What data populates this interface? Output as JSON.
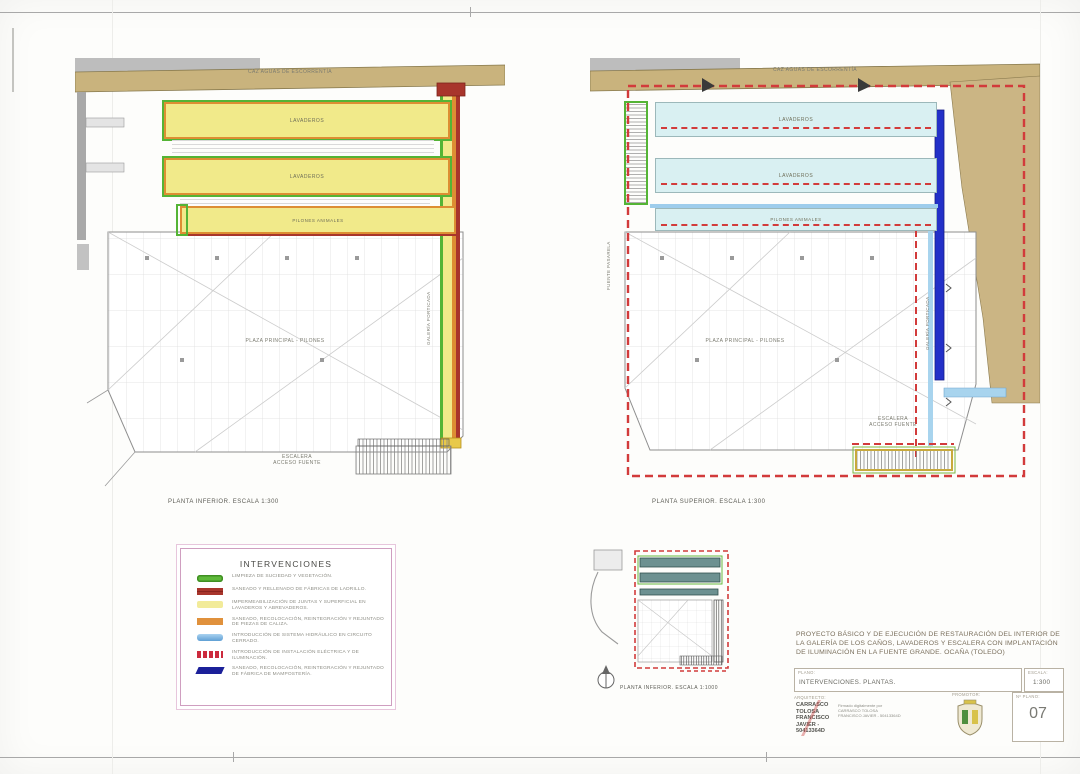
{
  "plans": {
    "lower": {
      "caption": "PLANTA INFERIOR. ESCALA 1:300",
      "caz_label": "CAZ AGUAS DE ESCORRENTÍA",
      "lavadero1_label": "LAVADEROS",
      "lavadero2_label": "LAVADEROS",
      "pilones_label": "PILONES ANIMALES",
      "plaza_label": "PLAZA PRINCIPAL - PILONES",
      "stairs_label": "ESCALERA\nACCESO FUENTE",
      "gallery_label": "GALERÍA PORTICADA"
    },
    "upper": {
      "caption": "PLANTA SUPERIOR. ESCALA 1:300",
      "caz_label": "CAZ AGUAS DE ESCORRENTÍA",
      "lavadero1_label": "LAVADEROS",
      "lavadero2_label": "LAVADEROS",
      "pilones_label": "PILONES ANIMALES",
      "plaza_label": "PLAZA PRINCIPAL - PILONES",
      "stairs_label": "ESCALERA\nACCESO FUENTE",
      "gallery_label": "GALERÍA PORTICADA",
      "pasarela_label": "FUENTE PASARELA"
    },
    "key": {
      "caption": "PLANTA INFERIOR. ESCALA 1:1000"
    }
  },
  "legend": {
    "title": "INTERVENCIONES",
    "items": [
      {
        "label": "LIMPIEZA DE SUCIEDAD Y VEGETACIÓN.",
        "color": "#5eb93a",
        "swatch_css": "background:#5eb93a;box-shadow:inset 0 0 0 1.5px #3f8f22;border-radius:3px"
      },
      {
        "label": "SANEADO Y RELLENADO DE FÁBRICAS DE LADRILLO.",
        "color": "#a8352c",
        "swatch_css": "background:repeating-linear-gradient(0deg,#a8352c 0 3px,#8a241e 3px 4px)"
      },
      {
        "label": "IMPERMEABILIZACIÓN DE JUNTAS Y SUPERFICIAL EN LAVADEROS Y ABREVADEROS.",
        "color": "#f2eb9a",
        "swatch_css": "background:#f2eb9a;border-radius:2px"
      },
      {
        "label": "SANEADO, RECOLOCACIÓN, REINTEGRACIÓN Y REJUNTADO DE PIEZAS DE CALIZA.",
        "color": "#e0913c",
        "swatch_css": "background:#e0913c"
      },
      {
        "label": "INTRODUCCIÓN DE SISTEMA HIDRÁULICO EN CIRCUITO CERRADO.",
        "color": "#7fb9e4",
        "swatch_css": "background:linear-gradient(#a9d2f0,#5f9fd4);border-radius:3px"
      },
      {
        "label": "INTRODUCCIÓN DE INSTALACIÓN ELÉCTRICA Y DE ILUMINACIÓN.",
        "color": "#cc2a3d",
        "swatch_css": "background:repeating-linear-gradient(90deg,#cc2a3d 0 4px,#ffffff 4px 6px)"
      },
      {
        "label": "SANEADO, RECOLOCACIÓN, REINTEGRACIÓN Y REJUNTADO DE FÁBRICA DE MAMPOSTERÍA.",
        "color": "#1b2099",
        "swatch_css": "background:#1b2099;transform:skewX(-25deg)"
      }
    ]
  },
  "titleblock": {
    "project_title": "PROYECTO BÁSICO Y DE EJECUCIÓN DE RESTAURACIÓN DEL INTERIOR DE LA GALERÍA DE LOS CAÑOS, LAVADEROS Y ESCALERA CON IMPLANTACIÓN DE ILUMINACIÓN EN LA FUENTE GRANDE. OCAÑA (TOLEDO)",
    "plano_label": "PLANO:",
    "plano_value": "INTERVENCIONES. PLANTAS.",
    "escala_label": "ESCALA:",
    "escala_value": "1:300",
    "arquitecto_label": "ARQUITECTO:",
    "arquitecto_name": "CARRASCO\nTOLOSA\nFRANCISCO\nJAVIER -\n50413364D",
    "signature_text": "Firmado digitalmente por CARRASCO TOLOSA FRANCISCO JAVIER - 50413364D",
    "promotor_label": "PROMOTOR:",
    "plano_num_label": "Nº PLANO:",
    "plano_num_value": "07"
  }
}
